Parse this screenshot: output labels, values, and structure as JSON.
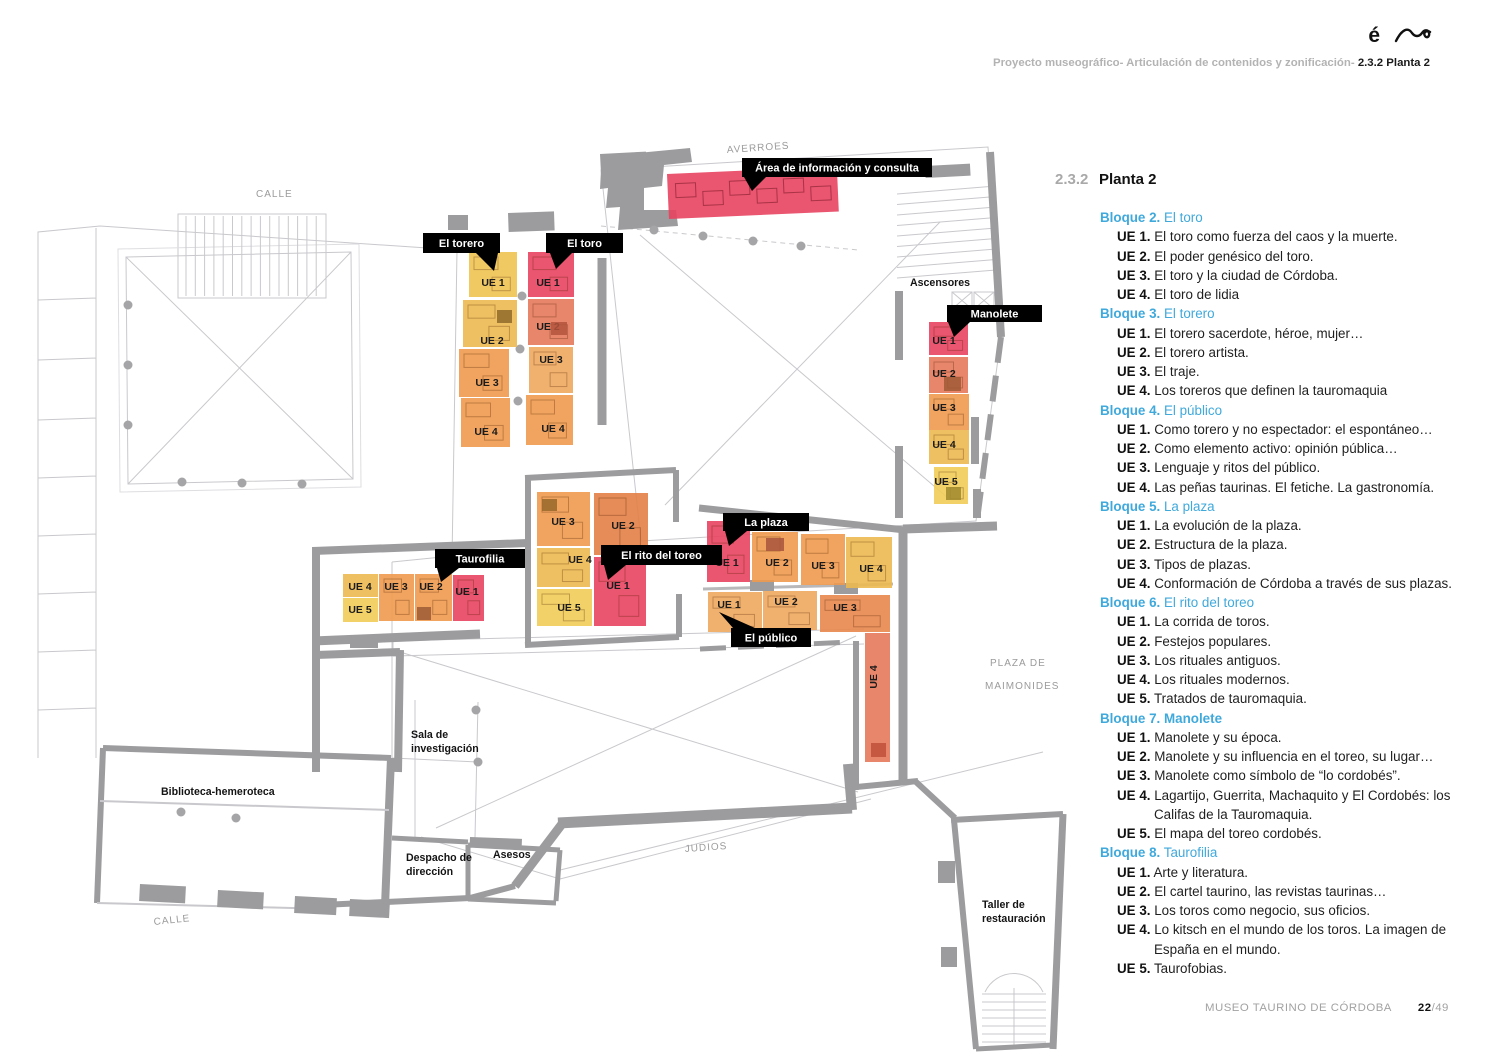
{
  "header": {
    "logo_accent": "é",
    "breadcrumb_gray": "Proyecto museográfico- Articulación de contenidos y zonificación- ",
    "breadcrumb_bold": "2.3.2 Planta 2"
  },
  "legend": {
    "section_number": "2.3.2",
    "title": "Planta 2",
    "accent_color": "#3fa9dc",
    "blocks": [
      {
        "num": "Bloque 2.",
        "title": "El toro",
        "title_bold": false,
        "items": [
          {
            "ue": "UE 1.",
            "text": "El toro como fuerza del caos y la muerte."
          },
          {
            "ue": "UE 2.",
            "text": "El poder genésico del toro."
          },
          {
            "ue": "UE 3.",
            "text": "El toro y la ciudad de Córdoba."
          },
          {
            "ue": "UE 4.",
            "text": "El toro de lidia"
          }
        ]
      },
      {
        "num": "Bloque 3.",
        "title": "El torero",
        "title_bold": false,
        "items": [
          {
            "ue": "UE 1.",
            "text": "El torero sacerdote, héroe, mujer…"
          },
          {
            "ue": "UE 2.",
            "text": "El torero artista."
          },
          {
            "ue": "UE 3.",
            "text": "El traje."
          },
          {
            "ue": "UE 4.",
            "text": "Los toreros que definen la tauromaquia"
          }
        ]
      },
      {
        "num": "Bloque 4.",
        "title": "El público",
        "title_bold": false,
        "items": [
          {
            "ue": "UE 1.",
            "text": "Como torero y no espectador: el espontáneo…"
          },
          {
            "ue": "UE 2.",
            "text": "Como elemento activo: opinión pública…"
          },
          {
            "ue": "UE 3.",
            "text": "Lenguaje y ritos del público."
          },
          {
            "ue": "UE 4.",
            "text": "Las peñas taurinas. El fetiche. La gastronomía."
          }
        ]
      },
      {
        "num": "Bloque 5.",
        "title": "La plaza",
        "title_bold": false,
        "items": [
          {
            "ue": "UE 1.",
            "text": "La evolución de la plaza."
          },
          {
            "ue": "UE 2.",
            "text": "Estructura de la plaza."
          },
          {
            "ue": "UE 3.",
            "text": "Tipos de plazas."
          },
          {
            "ue": "UE 4.",
            "text": "Conformación de Córdoba a través de sus plazas."
          }
        ]
      },
      {
        "num": "Bloque 6.",
        "title": "El rito del toreo",
        "title_bold": false,
        "items": [
          {
            "ue": "UE 1.",
            "text": "La corrida de toros."
          },
          {
            "ue": "UE 2.",
            "text": "Festejos populares."
          },
          {
            "ue": "UE 3.",
            "text": "Los rituales antiguos."
          },
          {
            "ue": "UE 4.",
            "text": "Los rituales modernos."
          },
          {
            "ue": "UE 5.",
            "text": "Tratados de tauromaquia."
          }
        ]
      },
      {
        "num": "Bloque 7.",
        "title": "Manolete",
        "title_bold": true,
        "items": [
          {
            "ue": "UE 1.",
            "text": "Manolete y su época."
          },
          {
            "ue": "UE 2.",
            "text": "Manolete y su influencia en el toreo, su lugar…"
          },
          {
            "ue": "UE 3.",
            "text": "Manolete como símbolo de “lo cordobés”."
          },
          {
            "ue": "UE 4.",
            "text": "Lagartijo, Guerrita, Machaquito y El Cordobés: los Califas de la Tauromaquia."
          },
          {
            "ue": "UE 5.",
            "text": "El mapa del toreo cordobés."
          }
        ]
      },
      {
        "num": "Bloque 8.",
        "title": "Taurofilia",
        "title_bold": false,
        "items": [
          {
            "ue": "UE 1.",
            "text": "Arte y literatura."
          },
          {
            "ue": "UE 2.",
            "text": "El cartel taurino, las revistas taurinas…"
          },
          {
            "ue": "UE 3.",
            "text": "Los toros como negocio, sus oficios."
          },
          {
            "ue": "UE 4.",
            "text": "Lo kitsch en el mundo de los toros. La imagen de España en el mundo."
          },
          {
            "ue": "UE 5.",
            "text": "Taurofobias."
          }
        ]
      }
    ]
  },
  "plan": {
    "palette": {
      "red": "#e8425f",
      "salmon": "#e5795b",
      "orange": "#ee9a4e",
      "orangeLight": "#f0a95e",
      "orangeMid": "#e8874d",
      "orangeDark": "#e28046",
      "amber": "#edb950",
      "yellow": "#f0cc58",
      "yellowDeep": "#efc352"
    },
    "rooms": [
      {
        "group": "El torero",
        "label": "UE 1",
        "x": 469,
        "y": 252,
        "w": 48,
        "h": 45,
        "color": "yellowDeep",
        "lx": 493,
        "ly": 286
      },
      {
        "group": "El torero",
        "label": "UE 2",
        "x": 463,
        "y": 300,
        "w": 54,
        "h": 47,
        "color": "amber",
        "lx": 492,
        "ly": 344
      },
      {
        "group": "El torero",
        "label": "UE 3",
        "x": 459,
        "y": 349,
        "w": 50,
        "h": 48,
        "color": "orange",
        "lx": 487,
        "ly": 386
      },
      {
        "group": "El torero",
        "label": "UE 4",
        "x": 461,
        "y": 398,
        "w": 49,
        "h": 49,
        "color": "orange",
        "lx": 486,
        "ly": 435
      },
      {
        "group": "El toro",
        "label": "UE 1",
        "x": 528,
        "y": 252,
        "w": 46,
        "h": 45,
        "color": "red",
        "lx": 548,
        "ly": 286
      },
      {
        "group": "El toro",
        "label": "UE 2",
        "x": 528,
        "y": 299,
        "w": 46,
        "h": 46,
        "color": "salmon",
        "lx": 548,
        "ly": 330
      },
      {
        "group": "El toro",
        "label": "UE 3",
        "x": 529,
        "y": 347,
        "w": 44,
        "h": 46,
        "color": "orangeLight",
        "lx": 551,
        "ly": 363
      },
      {
        "group": "El toro",
        "label": "UE 4",
        "x": 526,
        "y": 395,
        "w": 47,
        "h": 50,
        "color": "orange",
        "lx": 553,
        "ly": 432
      },
      {
        "group": "Manolete",
        "label": "UE 1",
        "x": 929,
        "y": 322,
        "w": 39,
        "h": 33,
        "color": "red",
        "lx": 944,
        "ly": 344
      },
      {
        "group": "Manolete",
        "label": "UE 2",
        "x": 929,
        "y": 357,
        "w": 39,
        "h": 36,
        "color": "salmon",
        "lx": 944,
        "ly": 377
      },
      {
        "group": "Manolete",
        "label": "UE 3",
        "x": 929,
        "y": 394,
        "w": 40,
        "h": 36,
        "color": "orange",
        "lx": 944,
        "ly": 411
      },
      {
        "group": "Manolete",
        "label": "UE 4",
        "x": 929,
        "y": 430,
        "w": 40,
        "h": 34,
        "color": "amber",
        "lx": 944,
        "ly": 448
      },
      {
        "group": "Manolete",
        "label": "UE 5",
        "x": 934,
        "y": 467,
        "w": 34,
        "h": 37,
        "color": "yellow",
        "lx": 946,
        "ly": 485
      },
      {
        "group": "Taurofilia",
        "label": "UE 4",
        "x": 343,
        "y": 574,
        "w": 35,
        "h": 23,
        "color": "amber",
        "lx": 360,
        "ly": 590
      },
      {
        "group": "Taurofilia",
        "label": "UE 5",
        "x": 343,
        "y": 598,
        "w": 35,
        "h": 24,
        "color": "yellow",
        "lx": 360,
        "ly": 613
      },
      {
        "group": "Taurofilia",
        "label": "UE 3",
        "x": 379,
        "y": 574,
        "w": 35,
        "h": 47,
        "color": "orange",
        "lx": 396,
        "ly": 590
      },
      {
        "group": "Taurofilia",
        "label": "UE 2",
        "x": 415,
        "y": 574,
        "w": 37,
        "h": 47,
        "color": "orange",
        "lx": 431,
        "ly": 590
      },
      {
        "group": "Taurofilia",
        "label": "UE 1",
        "x": 453,
        "y": 575,
        "w": 31,
        "h": 46,
        "color": "red",
        "lx": 467,
        "ly": 595
      },
      {
        "group": "El rito del toreo",
        "label": "UE 3",
        "x": 537,
        "y": 492,
        "w": 53,
        "h": 54,
        "color": "orange",
        "lx": 563,
        "ly": 525
      },
      {
        "group": "El rito del toreo",
        "label": "UE 2",
        "x": 594,
        "y": 493,
        "w": 54,
        "h": 62,
        "color": "orangeDark",
        "lx": 623,
        "ly": 529
      },
      {
        "group": "El rito del toreo",
        "label": "UE 4",
        "x": 537,
        "y": 548,
        "w": 53,
        "h": 39,
        "color": "amber",
        "lx": 580,
        "ly": 563
      },
      {
        "group": "El rito del toreo",
        "label": "UE 5",
        "x": 537,
        "y": 589,
        "w": 55,
        "h": 37,
        "color": "yellow",
        "lx": 569,
        "ly": 611
      },
      {
        "group": "El rito del toreo",
        "label": "UE 1",
        "x": 594,
        "y": 557,
        "w": 52,
        "h": 69,
        "color": "red",
        "lx": 618,
        "ly": 589
      },
      {
        "group": "La plaza",
        "label": "UE 1",
        "x": 707,
        "y": 521,
        "w": 43,
        "h": 61,
        "color": "red",
        "lx": 727,
        "ly": 566
      },
      {
        "group": "La plaza",
        "label": "UE 2",
        "x": 752,
        "y": 532,
        "w": 46,
        "h": 50,
        "color": "orange",
        "lx": 777,
        "ly": 566
      },
      {
        "group": "La plaza",
        "label": "UE 3",
        "x": 801,
        "y": 534,
        "w": 44,
        "h": 51,
        "color": "orange",
        "lx": 823,
        "ly": 569
      },
      {
        "group": "La plaza",
        "label": "UE 4",
        "x": 846,
        "y": 537,
        "w": 46,
        "h": 51,
        "color": "amber",
        "lx": 871,
        "ly": 572
      },
      {
        "group": "El público",
        "label": "UE 1",
        "x": 708,
        "y": 592,
        "w": 54,
        "h": 40,
        "color": "orangeLight",
        "lx": 729,
        "ly": 608
      },
      {
        "group": "El público",
        "label": "UE 2",
        "x": 763,
        "y": 591,
        "w": 54,
        "h": 39,
        "color": "orangeLight",
        "lx": 786,
        "ly": 605
      },
      {
        "group": "El público",
        "label": "UE 3",
        "x": 820,
        "y": 595,
        "w": 70,
        "h": 37,
        "color": "orangeMid",
        "lx": 845,
        "ly": 611
      },
      {
        "group": "El público",
        "label": "UE 4",
        "x": 865,
        "y": 633,
        "w": 25,
        "h": 129,
        "color": "salmon",
        "lx": 877,
        "ly": 677,
        "labelRot": -90
      },
      {
        "group": "Área de información y consulta",
        "label": "",
        "x": 667,
        "y": 174,
        "w": 170,
        "h": 45,
        "color": "red",
        "rot": -2.5
      }
    ],
    "accents": [
      {
        "x": 497,
        "y": 310,
        "w": 15,
        "h": 13,
        "fill": "#8f6b2b"
      },
      {
        "x": 551,
        "y": 322,
        "w": 16,
        "h": 13,
        "fill": "#b3543c"
      },
      {
        "x": 944,
        "y": 377,
        "w": 17,
        "h": 14,
        "fill": "#a05a35"
      },
      {
        "x": 946,
        "y": 487,
        "w": 15,
        "h": 13,
        "fill": "#a08a2e"
      },
      {
        "x": 417,
        "y": 607,
        "w": 14,
        "h": 13,
        "fill": "#9c5a36"
      },
      {
        "x": 542,
        "y": 499,
        "w": 15,
        "h": 12,
        "fill": "#96682c"
      },
      {
        "x": 766,
        "y": 538,
        "w": 18,
        "h": 13,
        "fill": "#a8543c"
      },
      {
        "x": 871,
        "y": 743,
        "w": 15,
        "h": 14,
        "fill": "#bf4f3a"
      }
    ],
    "callouts": [
      {
        "label": "El torero",
        "x": 423,
        "y": 233,
        "w": 77,
        "h": 20,
        "tip": [
          [
            476,
            253
          ],
          [
            498,
            253
          ],
          [
            494,
            271
          ]
        ]
      },
      {
        "label": "El toro",
        "x": 546,
        "y": 233,
        "w": 77,
        "h": 20,
        "tip": [
          [
            550,
            253
          ],
          [
            572,
            253
          ],
          [
            556,
            269
          ]
        ]
      },
      {
        "label": "Área de información y consulta",
        "x": 742,
        "y": 158,
        "w": 190,
        "h": 19,
        "tip": [
          [
            744,
            177
          ],
          [
            766,
            177
          ],
          [
            752,
            191
          ]
        ]
      },
      {
        "label": "Manolete",
        "x": 947,
        "y": 305,
        "w": 95,
        "h": 17,
        "tip": [
          [
            948,
            322
          ],
          [
            970,
            322
          ],
          [
            954,
            337
          ]
        ]
      },
      {
        "label": "Taurofilia",
        "x": 435,
        "y": 549,
        "w": 90,
        "h": 19,
        "tip": [
          [
            437,
            568
          ],
          [
            459,
            568
          ],
          [
            441,
            582
          ]
        ]
      },
      {
        "label": "El rito del toreo",
        "x": 601,
        "y": 545,
        "w": 121,
        "h": 20,
        "tip": [
          [
            604,
            565
          ],
          [
            626,
            565
          ],
          [
            608,
            580
          ]
        ]
      },
      {
        "label": "La plaza",
        "x": 723,
        "y": 513,
        "w": 86,
        "h": 18,
        "tip": [
          [
            725,
            531
          ],
          [
            747,
            531
          ],
          [
            729,
            546
          ]
        ]
      },
      {
        "label": "El público",
        "x": 731,
        "y": 628,
        "w": 80,
        "h": 19,
        "tip": [
          [
            733,
            628
          ],
          [
            755,
            628
          ],
          [
            719,
            612
          ]
        ]
      }
    ],
    "street_labels": [
      {
        "text": "CALLE",
        "x": 256,
        "y": 197,
        "rot": 0
      },
      {
        "text": "AVERROES",
        "x": 727,
        "y": 153,
        "rot": -4
      },
      {
        "text": "CALLE",
        "x": 154,
        "y": 925,
        "rot": -6
      },
      {
        "text": "JUDIOS",
        "x": 685,
        "y": 852,
        "rot": -4
      },
      {
        "text": "PLAZA DE",
        "x": 990,
        "y": 666,
        "rot": 0
      },
      {
        "text": "MAIMONIDES",
        "x": 985,
        "y": 689,
        "rot": 0
      }
    ],
    "room_labels": [
      {
        "lines": [
          "Ascensores"
        ],
        "x": 910,
        "y": 286
      },
      {
        "lines": [
          "Sala de",
          "investigación"
        ],
        "x": 411,
        "y": 738
      },
      {
        "lines": [
          "Biblioteca-hemeroteca"
        ],
        "x": 161,
        "y": 795
      },
      {
        "lines": [
          "Despacho de",
          "dirección"
        ],
        "x": 406,
        "y": 861
      },
      {
        "lines": [
          "Asesos"
        ],
        "x": 493,
        "y": 858
      },
      {
        "lines": [
          "Taller de",
          "restauración"
        ],
        "x": 982,
        "y": 908
      }
    ]
  },
  "footer": {
    "museum": "MUSEO TAURINO DE CÓRDOBA",
    "page": "22",
    "total": "/49"
  }
}
